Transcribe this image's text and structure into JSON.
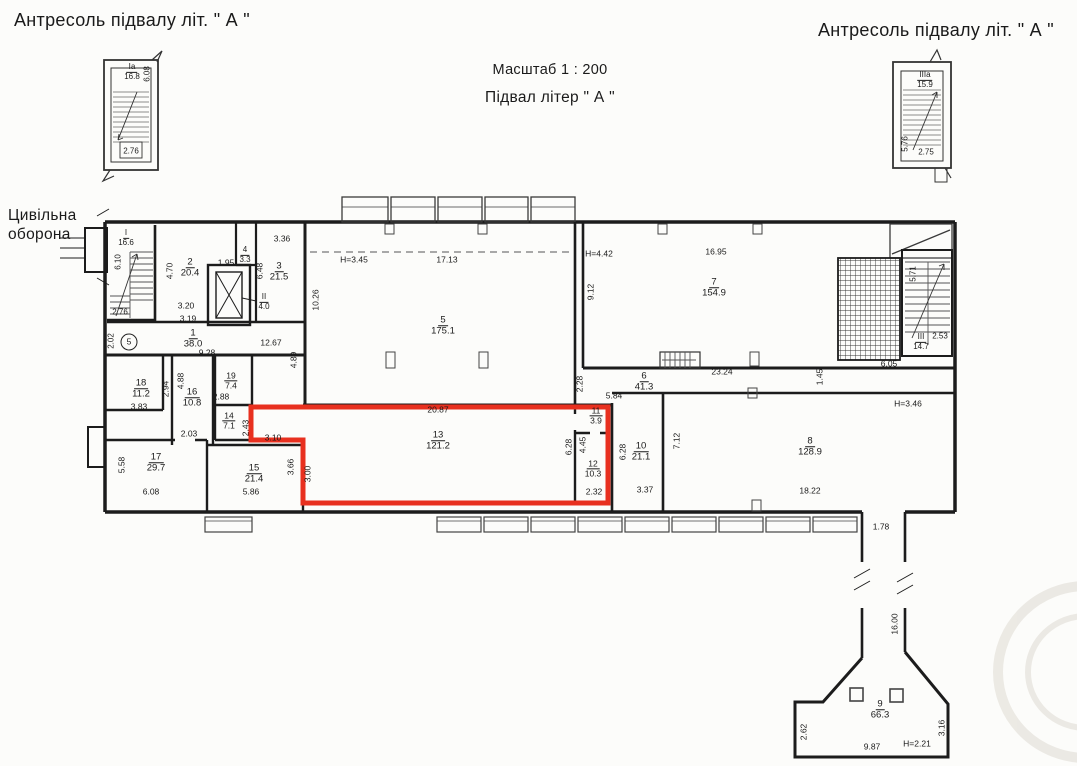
{
  "titles": {
    "top_left": "Антресоль підвалу  літ. \" А \"",
    "top_right": "Антресоль підвалу  літ. \" А \"",
    "scale": "Масштаб  1 : 200",
    "floor": "Підвал  літер \" А \"",
    "civil_defense": "Цивільна\nоборона"
  },
  "colors": {
    "highlight_red": "#e8301f",
    "wall": "#1c1c1c",
    "paper": "#fcfcfa"
  },
  "highlighted_room": {
    "number": "13",
    "area": "121.2"
  },
  "labels": [
    {
      "t": "Ia",
      "t2": "16.8",
      "x": 132,
      "y": 72,
      "s": 8
    },
    {
      "t": "6.08",
      "x": 148,
      "y": 74,
      "r": 1,
      "s": 8
    },
    {
      "t": "2.76",
      "x": 131,
      "y": 152,
      "s": 8
    },
    {
      "t": "IIIa",
      "t2": "15.9",
      "x": 925,
      "y": 80,
      "s": 8
    },
    {
      "t": "5.76",
      "x": 906,
      "y": 144,
      "r": 1,
      "s": 8
    },
    {
      "t": "2.75",
      "x": 926,
      "y": 153,
      "s": 8
    },
    {
      "t": "I",
      "t2": "16.6",
      "x": 126,
      "y": 238,
      "s": 8
    },
    {
      "t": "6.10",
      "x": 119,
      "y": 262,
      "r": 1,
      "s": 8
    },
    {
      "t": "2.76",
      "x": 120,
      "y": 313,
      "s": 8
    },
    {
      "t": "2.02",
      "x": 112,
      "y": 341,
      "r": 1,
      "s": 8
    },
    {
      "t": "5",
      "x": 129,
      "y": 342,
      "c": 1,
      "s": 8.5
    },
    {
      "t": "1",
      "t2": "38.0",
      "x": 193,
      "y": 339
    },
    {
      "t": "9.28",
      "x": 207,
      "y": 353,
      "s": 8.5
    },
    {
      "t": "2",
      "t2": "20.4",
      "x": 190,
      "y": 268
    },
    {
      "t": "4.70",
      "x": 170,
      "y": 271,
      "r": 1,
      "s": 8.5
    },
    {
      "t": "3.20",
      "x": 186,
      "y": 306,
      "s": 8.5
    },
    {
      "t": "3.19",
      "x": 188,
      "y": 319,
      "s": 8.5
    },
    {
      "t": "1.95",
      "x": 226,
      "y": 263,
      "s": 8.5
    },
    {
      "t": "4",
      "t2": "3.3",
      "x": 245,
      "y": 255,
      "s": 8
    },
    {
      "t": "3.36",
      "x": 282,
      "y": 239,
      "s": 8.5
    },
    {
      "t": "3",
      "t2": "21.5",
      "x": 279,
      "y": 272
    },
    {
      "t": "6.48",
      "x": 260,
      "y": 271,
      "r": 1,
      "s": 8.5
    },
    {
      "t": "II",
      "t2": "4.0",
      "x": 264,
      "y": 302,
      "s": 8
    },
    {
      "t": "12.67",
      "x": 271,
      "y": 343,
      "s": 8.5
    },
    {
      "t": "10.26",
      "x": 316,
      "y": 300,
      "r": 1,
      "s": 8.5
    },
    {
      "t": "4.89",
      "x": 294,
      "y": 360,
      "r": 1,
      "s": 8.5
    },
    {
      "t": "H=3.45",
      "x": 354,
      "y": 260,
      "s": 8.5
    },
    {
      "t": "17.13",
      "x": 447,
      "y": 260,
      "s": 8.5
    },
    {
      "t": "5",
      "t2": "175.1",
      "x": 443,
      "y": 326
    },
    {
      "t": "H=4.42",
      "x": 599,
      "y": 254,
      "s": 8.5
    },
    {
      "t": "16.95",
      "x": 716,
      "y": 252,
      "s": 8.5
    },
    {
      "t": "7",
      "t2": "154.9",
      "x": 714,
      "y": 288
    },
    {
      "t": "9.12",
      "x": 591,
      "y": 292,
      "r": 1,
      "s": 8.5
    },
    {
      "t": "23.24",
      "x": 722,
      "y": 372,
      "s": 8.5
    },
    {
      "t": "1.45",
      "x": 820,
      "y": 377,
      "r": 1,
      "s": 8.5
    },
    {
      "t": "6.05",
      "x": 889,
      "y": 364,
      "s": 8.5
    },
    {
      "t": "5.71",
      "x": 914,
      "y": 274,
      "r": 1,
      "s": 8
    },
    {
      "t": "III",
      "t2": "14.7",
      "x": 921,
      "y": 342,
      "s": 8
    },
    {
      "t": "2.53",
      "x": 940,
      "y": 337,
      "s": 8
    },
    {
      "t": "2.28",
      "x": 580,
      "y": 384,
      "r": 1,
      "s": 8.5
    },
    {
      "t": "6",
      "t2": "41.3",
      "x": 644,
      "y": 382
    },
    {
      "t": "5.84",
      "x": 614,
      "y": 396,
      "s": 8.5
    },
    {
      "t": "11",
      "t2": "3.9",
      "x": 596,
      "y": 416,
      "s": 8.5
    },
    {
      "t": "6.28",
      "x": 569,
      "y": 447,
      "r": 1,
      "s": 8.5
    },
    {
      "t": "4.45",
      "x": 583,
      "y": 445,
      "r": 1,
      "s": 8.5
    },
    {
      "t": "13",
      "t2": "121.2",
      "x": 438,
      "y": 441
    },
    {
      "t": "20.87",
      "x": 438,
      "y": 410,
      "s": 8.5
    },
    {
      "t": "12",
      "t2": "10.3",
      "x": 593,
      "y": 469,
      "s": 8.5
    },
    {
      "t": "2.32",
      "x": 594,
      "y": 492,
      "s": 8.5
    },
    {
      "t": "6.28",
      "x": 623,
      "y": 452,
      "r": 1,
      "s": 8.5
    },
    {
      "t": "10",
      "t2": "21.1",
      "x": 641,
      "y": 452
    },
    {
      "t": "3.37",
      "x": 645,
      "y": 490,
      "s": 8.5
    },
    {
      "t": "7.12",
      "x": 677,
      "y": 441,
      "r": 1,
      "s": 8.5
    },
    {
      "t": "8",
      "t2": "128.9",
      "x": 810,
      "y": 447
    },
    {
      "t": "18.22",
      "x": 810,
      "y": 491,
      "s": 8.5
    },
    {
      "t": "H=3.46",
      "x": 908,
      "y": 404,
      "s": 8.5
    },
    {
      "t": "18",
      "t2": "11.2",
      "x": 141,
      "y": 389
    },
    {
      "t": "3.83",
      "x": 139,
      "y": 407,
      "s": 8.5
    },
    {
      "t": "2.94",
      "x": 166,
      "y": 389,
      "r": 1,
      "s": 8.5
    },
    {
      "t": "4.88",
      "x": 181,
      "y": 381,
      "r": 1,
      "s": 8.5
    },
    {
      "t": "16",
      "t2": "10.8",
      "x": 192,
      "y": 398
    },
    {
      "t": "2.03",
      "x": 189,
      "y": 434,
      "s": 8.5
    },
    {
      "t": "19",
      "t2": "7.4",
      "x": 231,
      "y": 381,
      "s": 8.5
    },
    {
      "t": "2.88",
      "x": 221,
      "y": 397,
      "s": 8.5
    },
    {
      "t": "14",
      "t2": "7.1",
      "x": 229,
      "y": 421,
      "s": 8.5
    },
    {
      "t": "2.43",
      "x": 246,
      "y": 428,
      "r": 1,
      "s": 8.5
    },
    {
      "t": "3.10",
      "x": 273,
      "y": 438,
      "s": 8.5
    },
    {
      "t": "17",
      "t2": "29.7",
      "x": 156,
      "y": 463
    },
    {
      "t": "5.58",
      "x": 122,
      "y": 465,
      "r": 1,
      "s": 8.5
    },
    {
      "t": "6.08",
      "x": 151,
      "y": 492,
      "s": 8.5
    },
    {
      "t": "15",
      "t2": "21.4",
      "x": 254,
      "y": 474
    },
    {
      "t": "5.86",
      "x": 251,
      "y": 492,
      "s": 8.5
    },
    {
      "t": "3.66",
      "x": 291,
      "y": 467,
      "r": 1,
      "s": 8.5
    },
    {
      "t": "3.00",
      "x": 308,
      "y": 474,
      "r": 1,
      "s": 8.5
    },
    {
      "t": "1.78",
      "x": 881,
      "y": 527,
      "s": 8.5
    },
    {
      "t": "16.00",
      "x": 895,
      "y": 624,
      "r": 1,
      "s": 8.5
    },
    {
      "t": "9",
      "t2": "66.3",
      "x": 880,
      "y": 710
    },
    {
      "t": "9.87",
      "x": 872,
      "y": 747,
      "s": 8.5
    },
    {
      "t": "H=2.21",
      "x": 917,
      "y": 744,
      "s": 8.5
    },
    {
      "t": "3.16",
      "x": 942,
      "y": 728,
      "r": 1,
      "s": 8.5
    },
    {
      "t": "2.62",
      "x": 804,
      "y": 732,
      "r": 1,
      "s": 8.5
    }
  ]
}
